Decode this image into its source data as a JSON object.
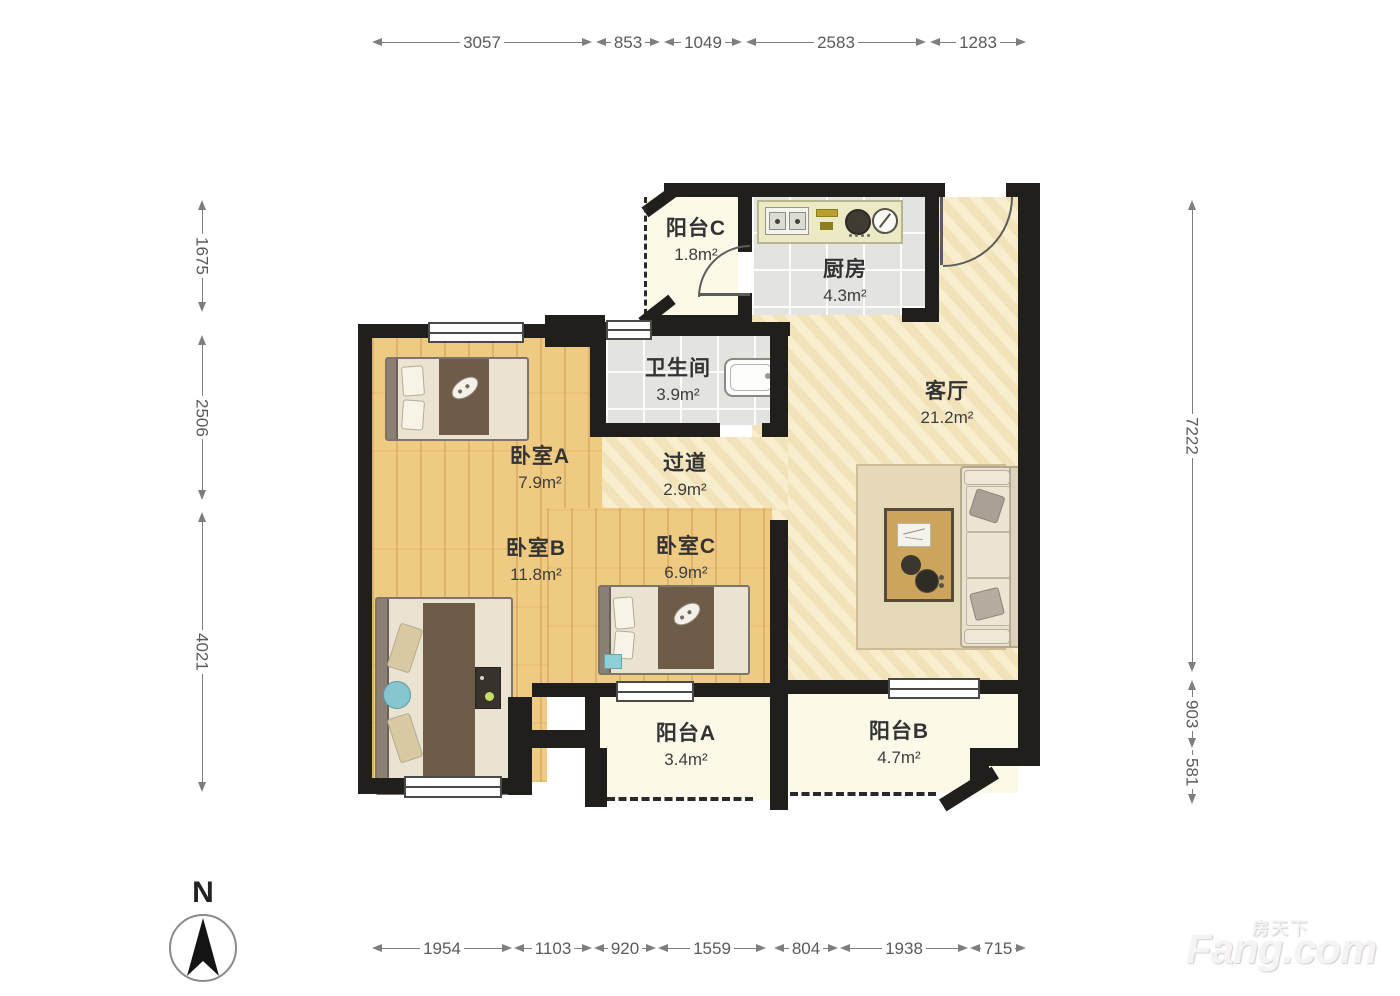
{
  "plan": {
    "compass_label": "N",
    "watermark": {
      "cn": "房天下",
      "en": "Fang.com"
    }
  },
  "rooms": [
    {
      "name": "阳台C",
      "area": "1.8m²"
    },
    {
      "name": "厨房",
      "area": "4.3m²"
    },
    {
      "name": "卫生间",
      "area": "3.9m²"
    },
    {
      "name": "过道",
      "area": "2.9m²"
    },
    {
      "name": "客厅",
      "area": "21.2m²"
    },
    {
      "name": "卧室A",
      "area": "7.9m²"
    },
    {
      "name": "卧室B",
      "area": "11.8m²"
    },
    {
      "name": "卧室C",
      "area": "6.9m²"
    },
    {
      "name": "阳台A",
      "area": "3.4m²"
    },
    {
      "name": "阳台B",
      "area": "4.7m²"
    }
  ],
  "dims": {
    "top": [
      "3057",
      "853",
      "1049",
      "2583",
      "1283"
    ],
    "bottom": [
      "1954",
      "1103",
      "920",
      "1559",
      "804",
      "1938",
      "715"
    ],
    "left": [
      "1675",
      "2506",
      "4021"
    ],
    "right": [
      "7222",
      "903",
      "581"
    ]
  }
}
